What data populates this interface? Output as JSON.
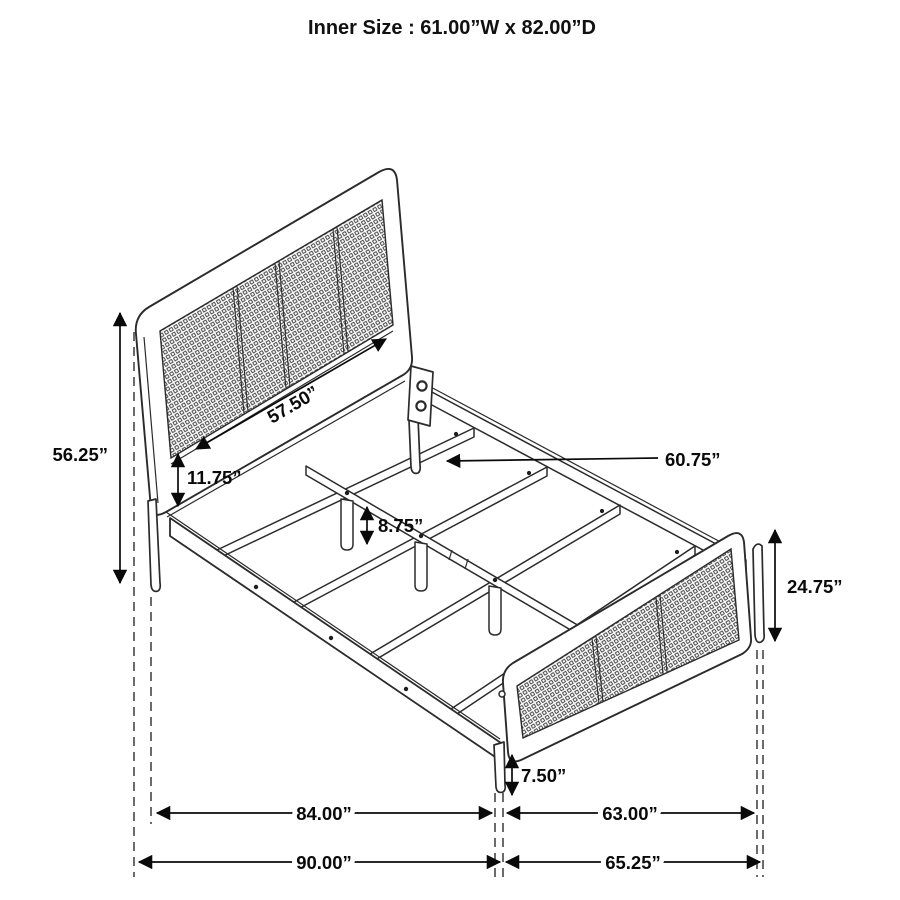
{
  "title": "Inner Size : 61.00”W x 82.00”D",
  "drawing": {
    "subject": "bed-frame-dimension-diagram",
    "style": "isometric line drawing, cane mesh headboard and footboard",
    "line_color": "#2b2b2b",
    "dimension_color": "#0a0a0a",
    "background_color": "#ffffff"
  },
  "labels": {
    "headboard_height": "56.25”",
    "headboard_panel_width": "57.50”",
    "headboard_rail_gap": "11.75”",
    "slat_support_rail_length": "60.75”",
    "center_leg_height": "8.75”",
    "footboard_height": "24.75”",
    "footboard_leg_height": "7.50”",
    "frame_inner_length": "84.00”",
    "footboard_span": "63.00”",
    "overall_length": "90.00”",
    "overall_width": "65.25”"
  }
}
